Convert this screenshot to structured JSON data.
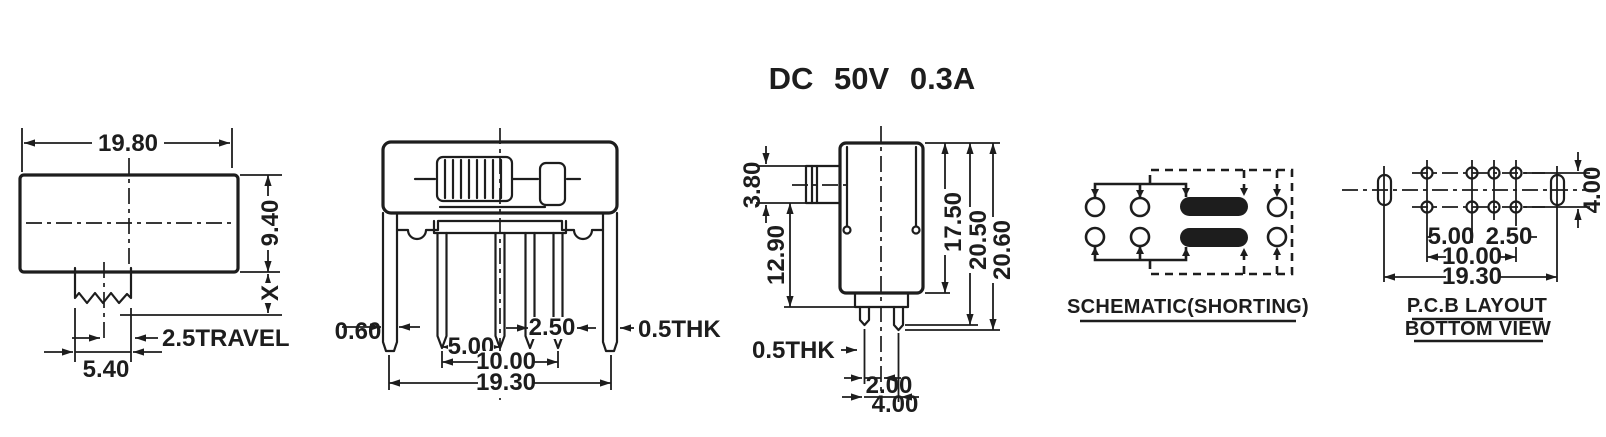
{
  "title": "DC 50V 0.3A",
  "colors": {
    "ink": "#1d1d1d",
    "paper": "#ffffff"
  },
  "views": {
    "top": {
      "dim_width": "19.80",
      "dim_height": "9.40",
      "dim_x": "X",
      "dim_travel": "2.5TRAVEL",
      "dim_knob_width": "5.40"
    },
    "front": {
      "dim_leg_thickness": "0.60",
      "dim_pin_pitch": "5.00",
      "dim_pin_pitch_small": "2.50",
      "dim_terminal_thickness": "0.5THK",
      "dim_pin_span": "10.00",
      "dim_overall_width": "19.30"
    },
    "side": {
      "dim_knob_height": "3.80",
      "dim_body_lower": "12.90",
      "dim_body_height": "17.50",
      "dim_overall_a": "20.50",
      "dim_overall_b": "20.60",
      "dim_terminal_thickness": "0.5THK",
      "dim_pin_offset": "2.00",
      "dim_row_pitch": "4.00"
    },
    "schematic": {
      "caption": "SCHEMATIC(SHORTING)"
    },
    "pcb": {
      "caption_line1": "P.C.B LAYOUT",
      "caption_line2": "BOTTOM VIEW",
      "dim_pad_pitch": "5.00",
      "dim_pad_pitch_small": "2.50",
      "dim_pad_span": "10.00",
      "dim_slot_span": "19.30",
      "dim_row_pitch": "4.00"
    }
  }
}
